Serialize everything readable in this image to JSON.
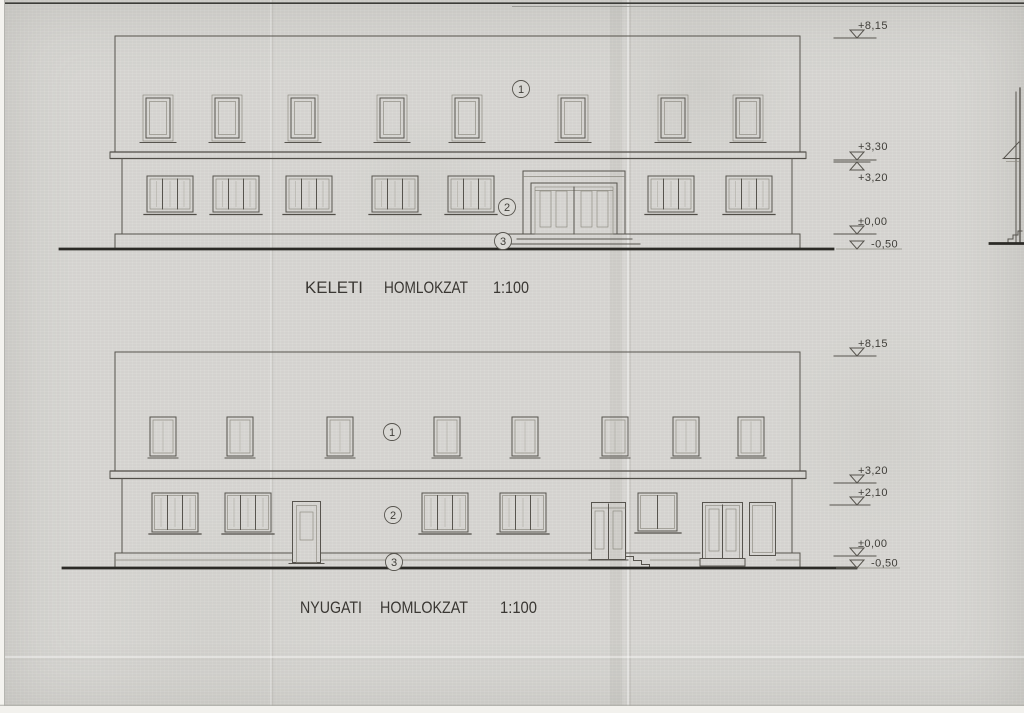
{
  "drawings": {
    "keleti": {
      "name": "KELETI",
      "type_label": "HOMLOKZAT",
      "scale": "1:100",
      "callouts": {
        "c1": "1",
        "c2": "2",
        "c3": "3"
      },
      "levels": {
        "roof": "+8,15",
        "cornice_upper": "+3,30",
        "cornice_lower": "+3,20",
        "floor": "±0,00",
        "terrain": "-0,50"
      }
    },
    "nyugati": {
      "name": "NYUGATI",
      "type_label": "HOMLOKZAT",
      "scale": "1:100",
      "callouts": {
        "c1": "1",
        "c2": "2",
        "c3": "3"
      },
      "levels": {
        "roof": "+8,15",
        "cornice": "+3,20",
        "door_head": "+2,10",
        "floor": "±0,00",
        "terrain": "-0,50"
      }
    }
  },
  "colors": {
    "paper": "#d9d8d4",
    "ink": "#57544e",
    "ink_dark": "#2b2a26"
  }
}
